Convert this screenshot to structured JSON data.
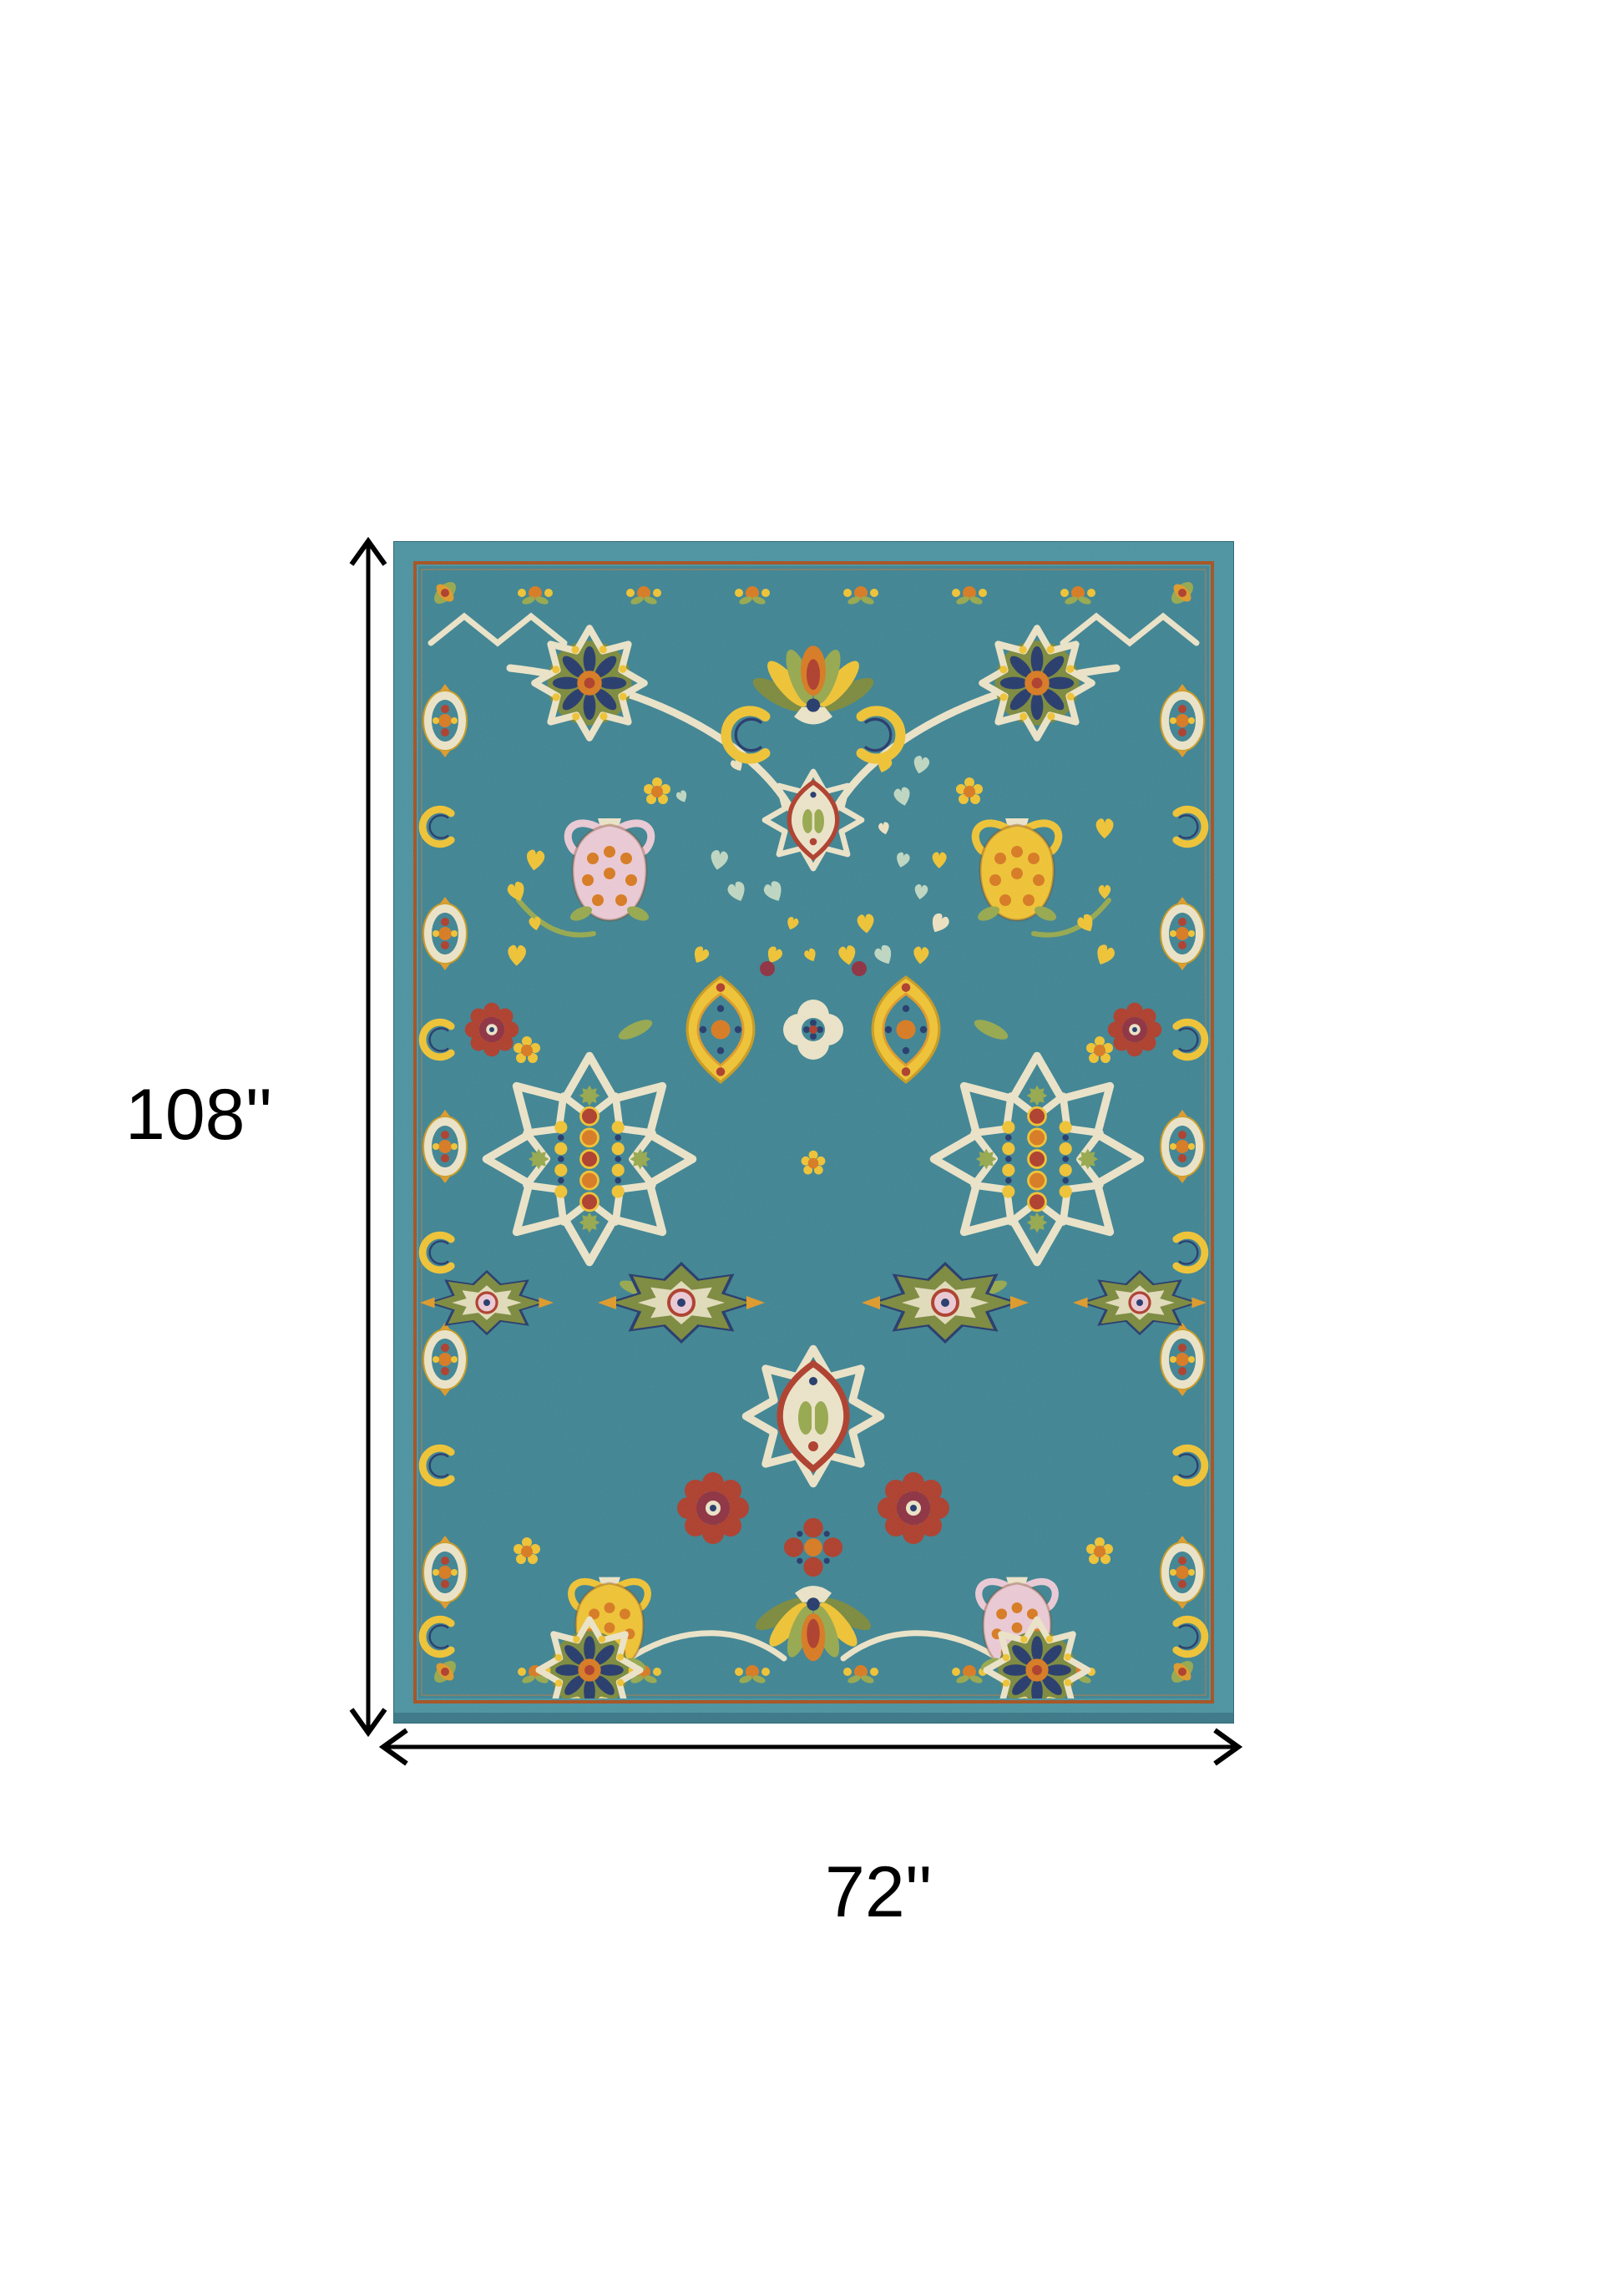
{
  "diagram": {
    "type": "product dimension diagram",
    "background_color": "#FFFFFF",
    "annotation_color": "#000000",
    "height_label": "108''",
    "width_label": "72''"
  },
  "rug": {
    "description": "Ornate teal blue multicolor persian-style floral area rug",
    "palette": {
      "outer_band_teal": "#4B93A1",
      "field_teal": "#3E8493",
      "rust": "#A6511F",
      "ivory": "#EDE5C9",
      "yellow": "#F1C433",
      "gold": "#E09A28",
      "orange": "#D97A20",
      "red": "#AF3D2B",
      "maroon": "#8E3040",
      "navy": "#24396B",
      "green": "#97A94D",
      "olive": "#7C8A3C",
      "pink": "#ECCBD6"
    }
  }
}
